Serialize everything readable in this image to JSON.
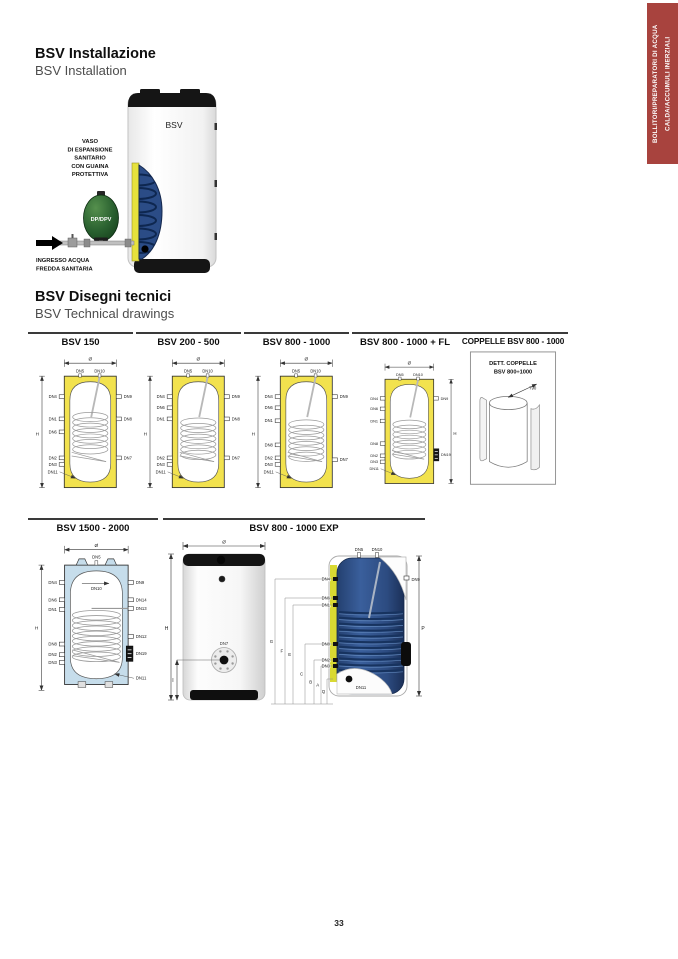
{
  "page": {
    "number": "33"
  },
  "side_tab": {
    "line1": "BOLLITORI/PREPARATORI DI ACQUA",
    "line2": "CALDA/ACCUMULI INERZIALI"
  },
  "installation": {
    "title_it": "BSV Installazione",
    "title_en": "BSV Installation",
    "tank_label": "BSV",
    "vessel_label": "DP/DPV",
    "expansion_caption": [
      "VASO",
      "DI ESPANSIONE",
      "SANITARIO",
      "CON GUAINA",
      "PROTETTIVA"
    ],
    "inlet_caption": [
      "INGRESSO ACQUA",
      "FREDDA SANITARIA"
    ]
  },
  "technical": {
    "title_it": "BSV Disegni tecnici",
    "title_en": "BSV Technical drawings"
  },
  "colors": {
    "accent_red": "#a8433e",
    "insulation_yellow": "#f2e24e",
    "insulation_blue": "#c6ddeb",
    "tank_navy": "#2e4d85",
    "cutaway_yellow": "#d9d932",
    "vessel_green": "#2a6130"
  },
  "row1": [
    {
      "type": "tank",
      "title": "BSV 150",
      "fill": "#f2e24e",
      "dia": "Ø",
      "h": "H",
      "h_side": "left",
      "coil_top": 70,
      "top_ports": [
        "DN5",
        "DN10"
      ],
      "left_ports": [
        {
          "l": "DN4",
          "y": 48
        },
        {
          "l": "DN1",
          "y": 72
        },
        {
          "l": "DN6",
          "y": 86
        },
        {
          "l": "DN2",
          "y": 114
        },
        {
          "l": "DN3",
          "y": 121
        },
        {
          "l": "DN11",
          "y": 129,
          "leader": true
        }
      ],
      "right_ports": [
        {
          "l": "DN9",
          "y": 48
        },
        {
          "l": "DN8",
          "y": 72
        },
        {
          "l": "DN7",
          "y": 114
        }
      ]
    },
    {
      "type": "tank",
      "title": "BSV 200 - 500",
      "fill": "#f2e24e",
      "dia": "Ø",
      "h": "H",
      "h_side": "left",
      "coil_top": 76,
      "top_ports": [
        "DN5",
        "DN10"
      ],
      "left_ports": [
        {
          "l": "DN4",
          "y": 48
        },
        {
          "l": "DN6",
          "y": 60
        },
        {
          "l": "DN1",
          "y": 72
        },
        {
          "l": "DN2",
          "y": 114
        },
        {
          "l": "DN3",
          "y": 121
        },
        {
          "l": "DN11",
          "y": 129,
          "leader": true
        }
      ],
      "right_ports": [
        {
          "l": "DN9",
          "y": 48
        },
        {
          "l": "DN8",
          "y": 72
        },
        {
          "l": "DN7",
          "y": 114
        }
      ]
    },
    {
      "type": "tank",
      "title": "BSV 800 - 1000",
      "fill": "#f2e24e",
      "dia": "Ø",
      "h": "H",
      "h_side": "left",
      "coil_top": 78,
      "top_ports": [
        "DN5",
        "DN10"
      ],
      "left_ports": [
        {
          "l": "DN4",
          "y": 48
        },
        {
          "l": "DN6",
          "y": 60
        },
        {
          "l": "DN1",
          "y": 74
        },
        {
          "l": "DN8",
          "y": 100
        },
        {
          "l": "DN2",
          "y": 114
        },
        {
          "l": "DN3",
          "y": 121
        },
        {
          "l": "DN11",
          "y": 129,
          "leader": true
        }
      ],
      "right_ports": [
        {
          "l": "DN9",
          "y": 48
        },
        {
          "l": "DN7",
          "y": 116
        }
      ]
    },
    {
      "type": "tank",
      "title": "BSV 800 - 1000 + FL",
      "fill": "#f2e24e",
      "dia": "Ø",
      "h": "H",
      "h_side": "right",
      "coil_top": 78,
      "top_ports": [
        "DN5",
        "DN10"
      ],
      "left_ports": [
        {
          "l": "DN4",
          "y": 48
        },
        {
          "l": "DN6",
          "y": 60
        },
        {
          "l": "DN1",
          "y": 74
        },
        {
          "l": "DN8",
          "y": 100
        },
        {
          "l": "DN2",
          "y": 114
        },
        {
          "l": "DN3",
          "y": 121
        },
        {
          "l": "DN11",
          "y": 129,
          "leader": true
        }
      ],
      "right_ports": [
        {
          "l": "DN9",
          "y": 48
        }
      ],
      "flange": {
        "l": "DN19",
        "y": 113
      }
    },
    {
      "type": "coppelle",
      "title": "COPPELLE BSV 800 - 1000",
      "box_title_1": "DETT. COPPELLE",
      "box_title_2": "BSV 800÷1000",
      "dim": "790"
    }
  ],
  "row2": [
    {
      "type": "tank1500",
      "title": "BSV 1500 - 2000",
      "fill": "#c6ddeb",
      "dia": "Ø",
      "h": "H",
      "top_port": "DN5",
      "inner_port": "DN10",
      "left_ports": [
        {
          "l": "DN4",
          "y": 46
        },
        {
          "l": "DN6",
          "y": 64
        },
        {
          "l": "DN1",
          "y": 74
        },
        {
          "l": "DN8",
          "y": 110
        },
        {
          "l": "DN2",
          "y": 121
        },
        {
          "l": "DN3",
          "y": 129
        }
      ],
      "right_ports": [
        {
          "l": "DN9",
          "y": 46
        },
        {
          "l": "DN14",
          "y": 64
        },
        {
          "l": "DN13",
          "y": 73
        },
        {
          "l": "DN12",
          "y": 102
        }
      ],
      "flange": "DN19",
      "bottom_right_port": "DN11"
    },
    {
      "type": "exp",
      "title": "BSV 800 - 1000 EXP",
      "cylinder": {
        "dia": "Ø",
        "h": "H",
        "i": "I",
        "flange": "DN7"
      },
      "cutaway": {
        "top_ports": [
          "DN5",
          "DN10"
        ],
        "right_port": "DN9",
        "p": "P",
        "bottom_port": "DN11",
        "left_ports": [
          {
            "l": "DN4",
            "y": 41
          },
          {
            "l": "DN6",
            "y": 60
          },
          {
            "l": "DN1",
            "y": 67
          },
          {
            "l": "DN8",
            "y": 106
          },
          {
            "l": "DN2",
            "y": 122
          },
          {
            "l": "DN3",
            "y": 128
          }
        ],
        "letters": [
          {
            "l": "G",
            "x": 112,
            "y": 41
          },
          {
            "l": "F",
            "x": 122,
            "y": 60
          },
          {
            "l": "E",
            "x": 130,
            "y": 67
          },
          {
            "l": "C",
            "x": 142,
            "y": 106
          },
          {
            "l": "B",
            "x": 151,
            "y": 122
          },
          {
            "l": "A",
            "x": 158,
            "y": 128
          },
          {
            "l": "Q",
            "x": 164,
            "y": 141
          }
        ]
      }
    }
  ]
}
